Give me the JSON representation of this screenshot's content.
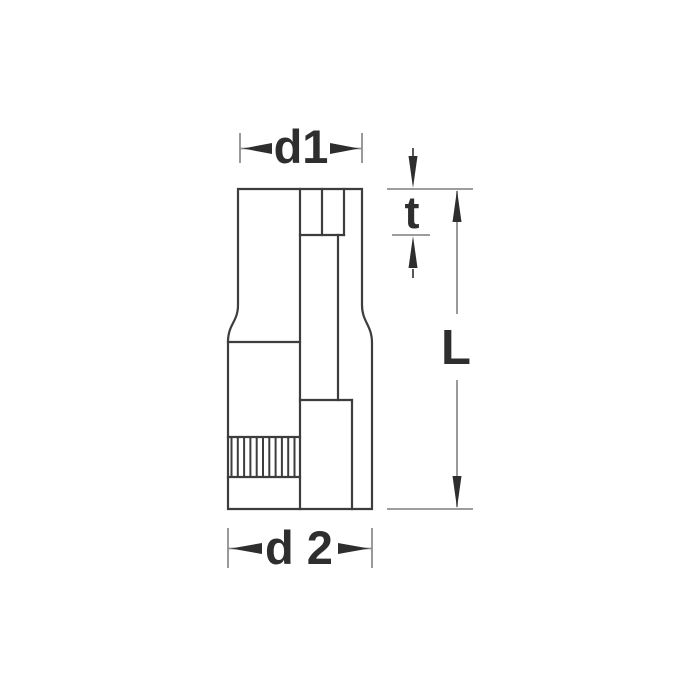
{
  "diagram": {
    "kind": "socket-tool-dimension-drawing",
    "labels": {
      "d1": "d1",
      "t": "t",
      "L": "L",
      "d2": "d 2"
    },
    "colors": {
      "background": "#ffffff",
      "object_line": "#3d3d3d",
      "dimension_line": "#8f8f8f",
      "arrow_text": "#2e2e2e"
    }
  }
}
